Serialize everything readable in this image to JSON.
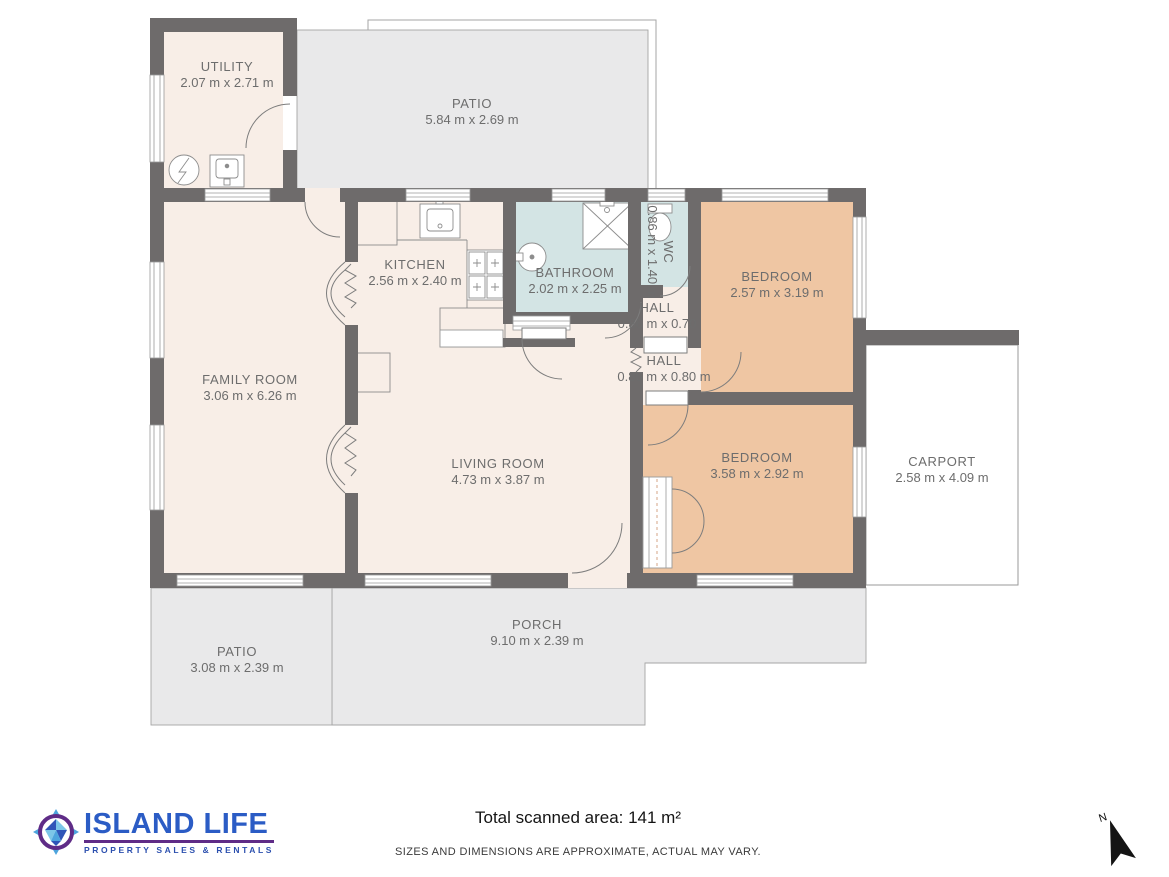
{
  "plan": {
    "rooms": [
      {
        "id": "utility",
        "name": "UTILITY",
        "dims": "2.07 m x 2.71 m"
      },
      {
        "id": "patio_top",
        "name": "PATIO",
        "dims": "5.84 m x 2.69 m"
      },
      {
        "id": "kitchen",
        "name": "KITCHEN",
        "dims": "2.56 m x 2.40 m"
      },
      {
        "id": "bathroom",
        "name": "BATHROOM",
        "dims": "2.02 m x 2.25 m"
      },
      {
        "id": "wc",
        "name": "WC",
        "dims": "0.86 m x 1.40 m"
      },
      {
        "id": "hall_upper",
        "name": "HALL",
        "dims": "0.86 m x 0.70"
      },
      {
        "id": "hall_lower",
        "name": "HALL",
        "dims": "0.86 m x 0.80 m"
      },
      {
        "id": "bedroom_1",
        "name": "BEDROOM",
        "dims": "2.57 m x 3.19 m"
      },
      {
        "id": "family_room",
        "name": "FAMILY ROOM",
        "dims": "3.06 m x 6.26 m"
      },
      {
        "id": "living_room",
        "name": "LIVING ROOM",
        "dims": "4.73 m x 3.87 m"
      },
      {
        "id": "bedroom_2",
        "name": "BEDROOM",
        "dims": "3.58 m x 2.92 m"
      },
      {
        "id": "carport",
        "name": "CARPORT",
        "dims": "2.58 m x 4.09 m"
      },
      {
        "id": "porch",
        "name": "PORCH",
        "dims": "9.10 m x 2.39 m"
      },
      {
        "id": "patio_bottom",
        "name": "PATIO",
        "dims": "3.08 m x 2.39 m"
      }
    ]
  },
  "footer": {
    "total_area": "Total scanned area: 141 m²",
    "disclaimer": "SIZES AND DIMENSIONS ARE APPROXIMATE, ACTUAL MAY VARY."
  },
  "logo": {
    "brand": "ISLAND LIFE",
    "tagline": "PROPERTY SALES & RENTALS"
  },
  "compass": {
    "label": "N"
  },
  "colors": {
    "wall": "#6e6b6b",
    "room_cream": "#f8eee7",
    "bathroom_blue": "#d3e4e4",
    "bedroom_tan": "#efc6a3",
    "outdoor_gray": "#e9e9ea",
    "carport_white": "#ffffff",
    "label_gray": "#6d6d6d",
    "logo_blue": "#2b5cc5",
    "logo_purple": "#5f2c87"
  }
}
